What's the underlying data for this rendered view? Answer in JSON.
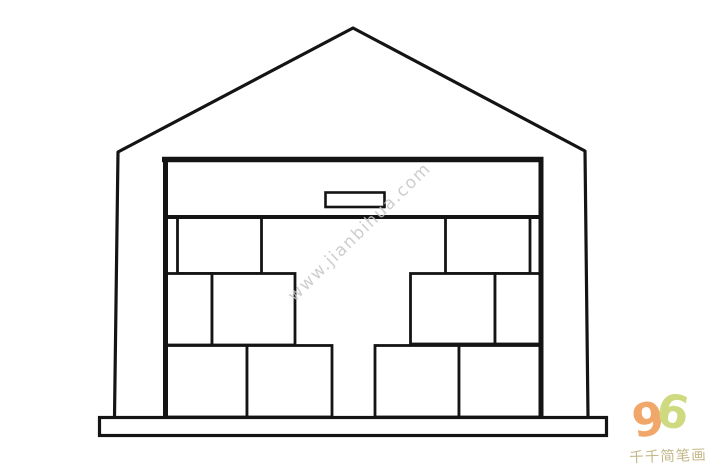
{
  "drawing": {
    "background": "#ffffff",
    "line_color": "#141414"
  },
  "watermark": {
    "text": "www.jianbihua.com",
    "color": "#c6c6c6"
  },
  "logo": {
    "digit_9": "9",
    "digit_6": "6",
    "color_9": "#f09a56",
    "color_6": "#c9d66f",
    "caption": "千千简笔画",
    "caption_color": "#bdae78"
  }
}
